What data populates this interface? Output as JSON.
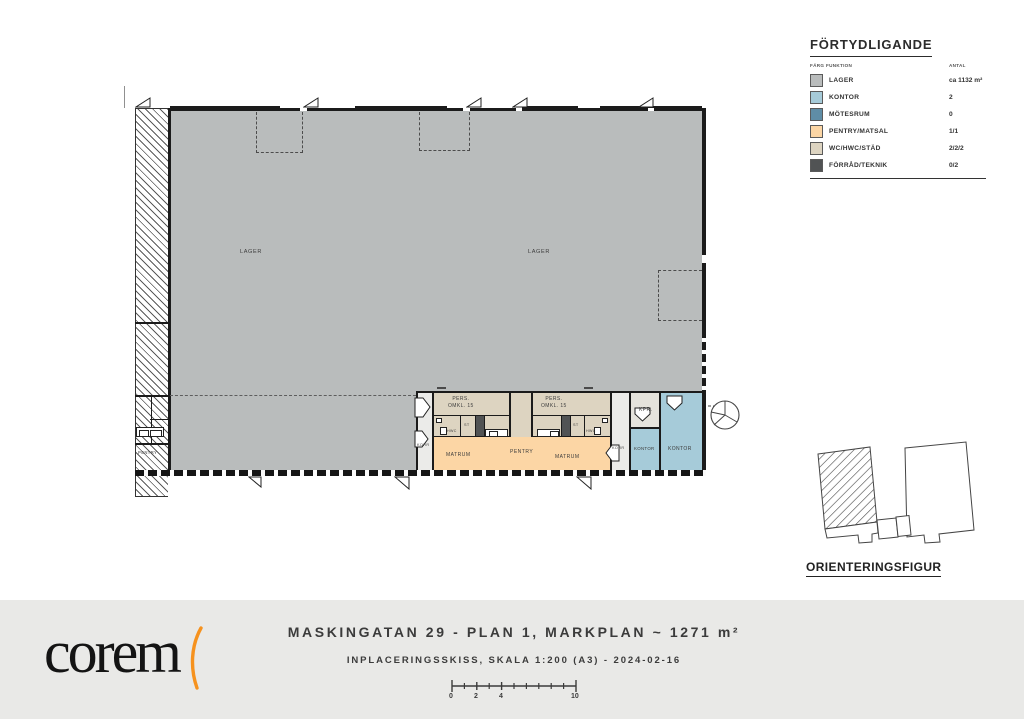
{
  "legend": {
    "title": "FÖRTYDLIGANDE",
    "columns": {
      "farg": "FÄRG",
      "funktion": "FUNKTION",
      "antal": "ANTAL"
    },
    "rows": [
      {
        "label": "LAGER",
        "antal": "ca 1132 m²",
        "color": "#b9bcbc"
      },
      {
        "label": "KONTOR",
        "antal": "2",
        "color": "#a6cbd9"
      },
      {
        "label": "MÖTESRUM",
        "antal": "0",
        "color": "#5f8da6"
      },
      {
        "label": "PENTRY/MATSAL",
        "antal": "1/1",
        "color": "#fcd6a5"
      },
      {
        "label": "WC/HWC/STÄD",
        "antal": "2/2/2",
        "color": "#ddd4c1"
      },
      {
        "label": "FÖRRÅD/TEKNIK",
        "antal": "0/2",
        "color": "#515354"
      }
    ]
  },
  "plan": {
    "lager_label": "LAGER",
    "korr": "KORR",
    "omkl": {
      "line1": "PERS.",
      "line2": "OMKL. 15"
    },
    "hwc": "HWC",
    "st": "ST",
    "matrum": "MATRUM",
    "pentry": "PENTRY",
    "kpr": "KPR.",
    "kontor": "KONTOR",
    "neighbor_pentry": "PENTRY",
    "colors": {
      "lager": "#b9bcbc",
      "kontor": "#a6cbd9",
      "pentry": "#fcd6a5",
      "wc": "#ddd4c1",
      "forrad": "#515354",
      "korr": "#ebebe9",
      "kpr": "#e5e3dc"
    }
  },
  "orientation": {
    "label": "ORIENTERINGSFIGUR"
  },
  "footer": {
    "logo": "corem",
    "logo_accent_color": "#f6921e",
    "title": "MASKINGATAN 29 - PLAN 1, MARKPLAN ~ 1271 m²",
    "subtitle": "INPLACERINGSSKISS, SKALA 1:200 (A3) - 2024-02-16",
    "scale_labels": [
      "0",
      "2",
      "4",
      "10"
    ]
  }
}
